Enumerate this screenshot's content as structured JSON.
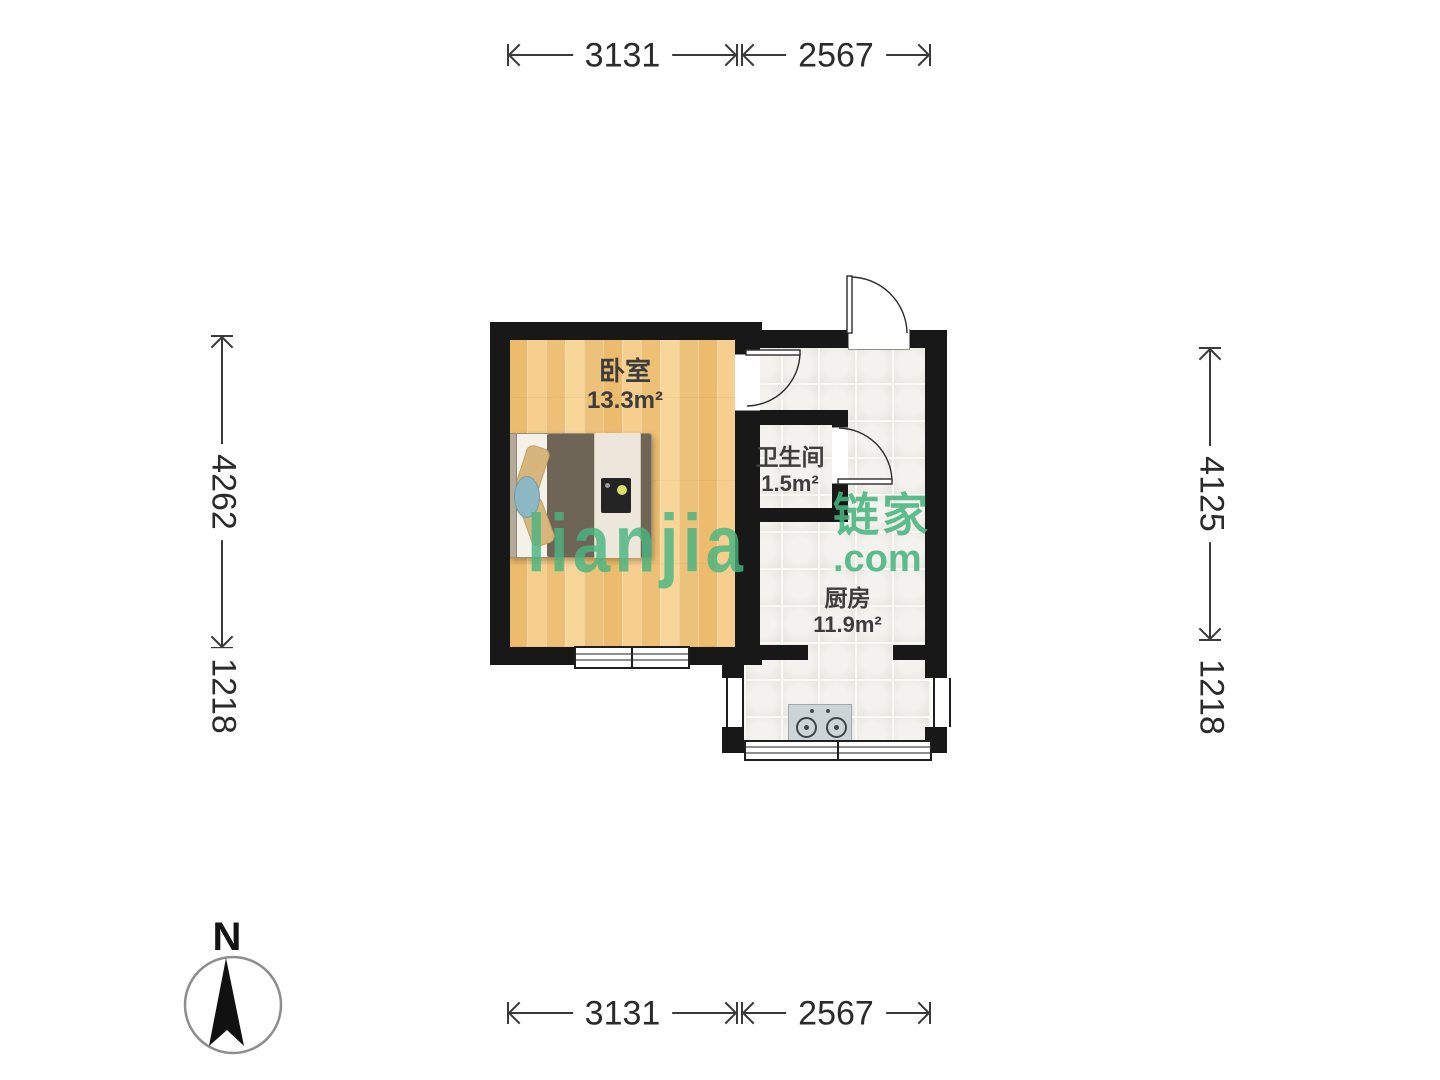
{
  "compass": {
    "label": "N"
  },
  "watermark": {
    "brand": "lianjia",
    "brand_cn": "链家",
    "domain": ".com"
  },
  "rooms": [
    {
      "id": "bedroom",
      "name": "卧室",
      "area": "13.3m²"
    },
    {
      "id": "bathroom",
      "name": "卫生间",
      "area": "1.5m²"
    },
    {
      "id": "kitchen",
      "name": "厨房",
      "area": "11.9m²"
    }
  ],
  "dimensions": {
    "top": [
      {
        "label": "3131"
      },
      {
        "label": "2567"
      }
    ],
    "bottom": [
      {
        "label": "3131"
      },
      {
        "label": "2567"
      }
    ],
    "left": [
      {
        "label": "4262"
      },
      {
        "label": "1218"
      }
    ],
    "right": [
      {
        "label": "4125"
      },
      {
        "label": "1218"
      }
    ]
  }
}
